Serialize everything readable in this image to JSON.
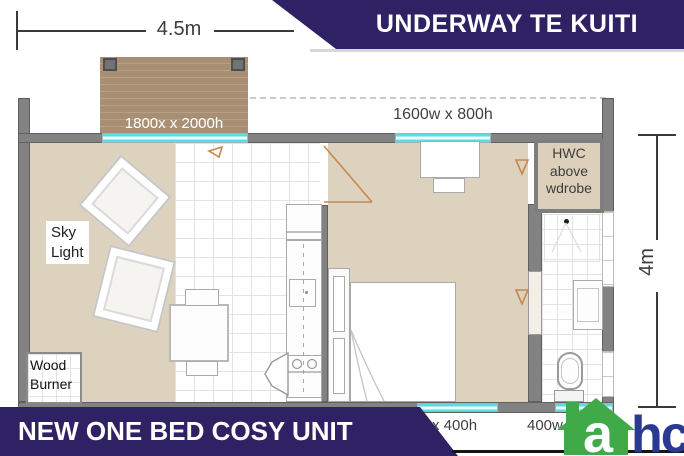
{
  "banner_top": {
    "title": "UNDERWAY TE KUITI"
  },
  "banner_bottom": {
    "title": "NEW ONE BED COSY UNIT"
  },
  "dimensions": {
    "width": "4.5m",
    "height": "4m"
  },
  "plan_labels": {
    "deck_slider": "1800x x 2000h",
    "top_window": "1600w x 800h",
    "hwc": "HWC\nabove\nwdrobe",
    "sky_light": "Sky\nLight",
    "wood_burner": "Wood\nBurner",
    "bottom_window_left": "x 400h",
    "bottom_window_right": "400w x 400h"
  },
  "logo": {
    "a": "a",
    "hc": "hc"
  },
  "colors": {
    "banner": "#2e2264",
    "window_glass": "#7de8ef",
    "wall": "#828282",
    "floor": "#ddd2bd",
    "deck": "#a88f73",
    "door_marks": "#c8874f",
    "logo_green": "#3faa47",
    "logo_navy": "#2b3990"
  }
}
